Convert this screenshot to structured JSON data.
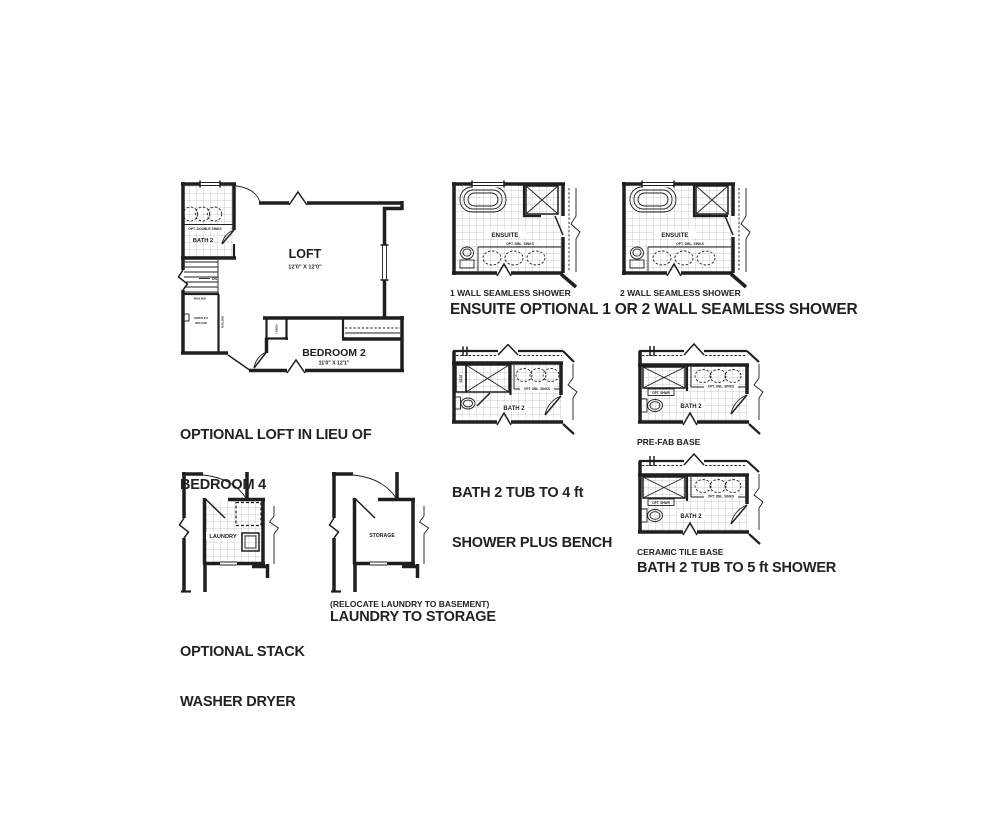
{
  "palette": {
    "background": "#ffffff",
    "ink": "#1f1f1f"
  },
  "loft": {
    "caption_line1": "OPTIONAL LOFT IN LIEU OF",
    "caption_line2": "BEDROOM 4",
    "room_label": "LOFT",
    "room_dims": "12'0\" X 12'0\"",
    "bedroom_label": "BEDROOM 2",
    "bedroom_dims": "11'0\" X 12'1\"",
    "bath_label": "BATH 2",
    "sinks_label": "OPT. DOUBLE SINKS",
    "railing_label": "RAILING",
    "railing_label_vertical": "RAILING",
    "open_below_line1": "OPEN TO",
    "open_below_line2": "BELOW",
    "down_label": "DN",
    "linen_label": "LINEN"
  },
  "ensuite": {
    "caption": "ENSUITE OPTIONAL 1 OR 2 WALL SEAMLESS SHOWER",
    "variant1_label": "1 WALL SEAMLESS SHOWER",
    "variant2_label": "2 WALL SEAMLESS SHOWER",
    "room_label": "ENSUITE",
    "sinks_label": "OPT. DBL. SINKS"
  },
  "bath_4ft": {
    "caption_line1": "BATH 2 TUB TO 4 ft",
    "caption_line2": "SHOWER PLUS BENCH",
    "room_label": "BATH 2",
    "seat_label": "SEAT",
    "sinks_label": "OPT. DBL. SINKS"
  },
  "bath_5ft": {
    "caption": "BATH 2 TUB TO 5 ft SHOWER",
    "prefab_label": "PRE-FAB BASE",
    "ceramic_label": "CERAMIC TILE BASE",
    "room_label": "BATH 2",
    "shower_label": "OPT. SHWR",
    "sinks_label": "OPT. DBL. SINKS"
  },
  "laundry": {
    "caption_line1": "OPTIONAL STACK",
    "caption_line2": "WASHER DRYER",
    "room_label": "LAUNDRY"
  },
  "storage": {
    "note": "(RELOCATE LAUNDRY TO BASEMENT)",
    "caption": "LAUNDRY TO STORAGE",
    "room_label": "STORAGE"
  }
}
